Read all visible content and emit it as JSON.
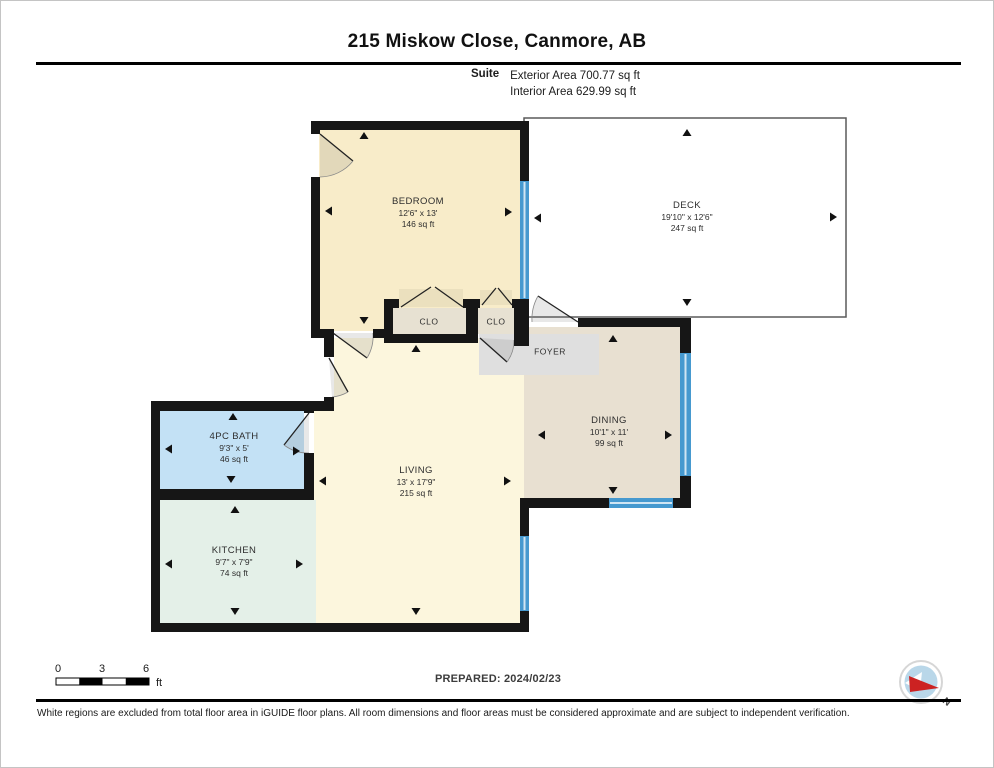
{
  "title": "215 Miskow Close, Canmore, AB",
  "subtitle": {
    "label": "Suite",
    "line1": "Exterior Area 700.77 sq ft",
    "line2": "Interior Area 629.99 sq ft"
  },
  "rooms": {
    "bedroom": {
      "name": "BEDROOM",
      "dims": "12'6\" x 13'",
      "area": "146 sq ft",
      "fill": "#f8ecc9"
    },
    "deck": {
      "name": "DECK",
      "dims": "19'10\" x 12'6\"",
      "area": "247 sq ft",
      "fill": "#ffffff"
    },
    "closet1": {
      "name": "CLO",
      "fill": "#e7e1d2"
    },
    "closet2": {
      "name": "CLO",
      "fill": "#e7e1d2"
    },
    "foyer": {
      "name": "FOYER",
      "fill": "#dfdfdf"
    },
    "dining": {
      "name": "DINING",
      "dims": "10'1\" x 11'",
      "area": "99 sq ft",
      "fill": "#e8e0d1"
    },
    "bath": {
      "name": "4PC BATH",
      "dims": "9'3\" x 5'",
      "area": "46 sq ft",
      "fill": "#c3e1f5"
    },
    "living": {
      "name": "LIVING",
      "dims": "13' x 17'9\"",
      "area": "215 sq ft",
      "fill": "#fcf6dd"
    },
    "kitchen": {
      "name": "KITCHEN",
      "dims": "9'7\" x 7'9\"",
      "area": "74 sq ft",
      "fill": "#e4f0e8"
    }
  },
  "scale_bar": {
    "ticks": [
      "0",
      "3",
      "6"
    ],
    "unit": "ft"
  },
  "prepared_label": "PREPARED: 2024/02/23",
  "compass": {
    "label": "N"
  },
  "footer": "White regions are excluded from total floor area in iGUIDE floor plans. All room dimensions and floor areas must be considered approximate and are subject to independent verification.",
  "colors": {
    "wall": "#161616",
    "window": "#4699cf",
    "deck_border": "#5a5a5a"
  }
}
